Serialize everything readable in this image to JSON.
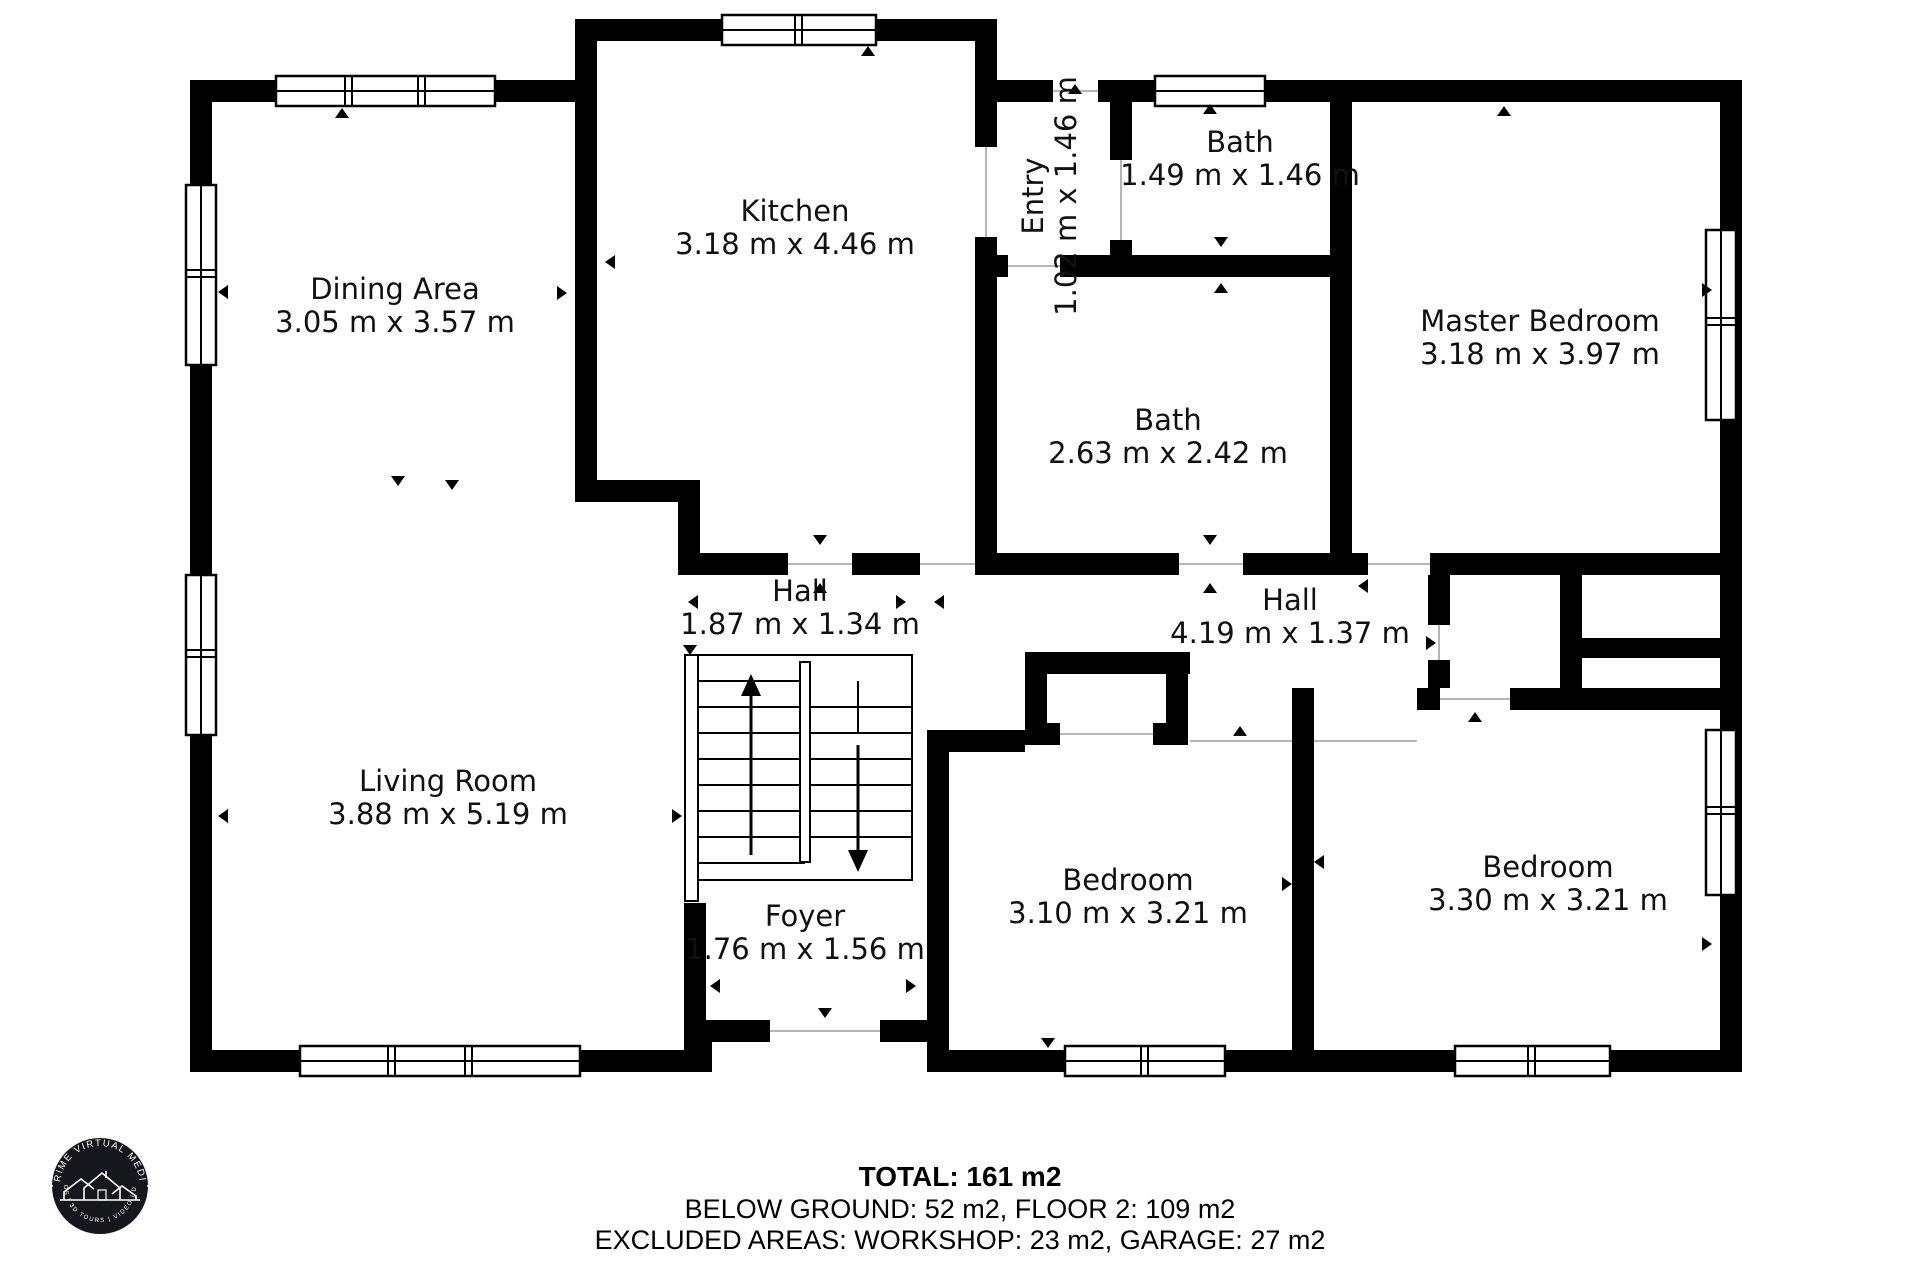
{
  "rooms": [
    {
      "name": "Dining Area",
      "dims": "3.05 m x 3.57 m"
    },
    {
      "name": "Kitchen",
      "dims": "3.18 m x 4.46 m"
    },
    {
      "name": "Entry",
      "dims": "1.02 m x 1.46 m"
    },
    {
      "name": "Bath",
      "dims": "1.49 m x 1.46 m"
    },
    {
      "name": "Master Bedroom",
      "dims": "3.18 m x 3.97 m"
    },
    {
      "name": "Bath",
      "dims": "2.63 m x 2.42 m"
    },
    {
      "name": "Hall",
      "dims": "1.87 m x 1.34 m"
    },
    {
      "name": "Hall",
      "dims": "4.19 m x 1.37 m"
    },
    {
      "name": "Living Room",
      "dims": "3.88 m x 5.19 m"
    },
    {
      "name": "Foyer",
      "dims": "1.76 m x 1.56 m"
    },
    {
      "name": "Bedroom",
      "dims": "3.10 m x 3.21 m"
    },
    {
      "name": "Bedroom",
      "dims": "3.30 m x 3.21 m"
    }
  ],
  "footer": {
    "total": "TOTAL: 161 m2",
    "line1": "BELOW GROUND: 52 m2, FLOOR 2: 109 m2",
    "line2": "EXCLUDED AREAS: WORKSHOP: 23 m2, GARAGE: 27 m2",
    "disclaimer": "Measurements Are Deemed Highly Reliable. Actual May Vary."
  },
  "logo": {
    "arc_top": "PRIME VIRTUAL MEDIA",
    "arc_bottom": "PHOTOS | 3D TOURS | VIDEO | DRONE"
  },
  "colors": {
    "wall": "#000000",
    "background": "#ffffff"
  }
}
